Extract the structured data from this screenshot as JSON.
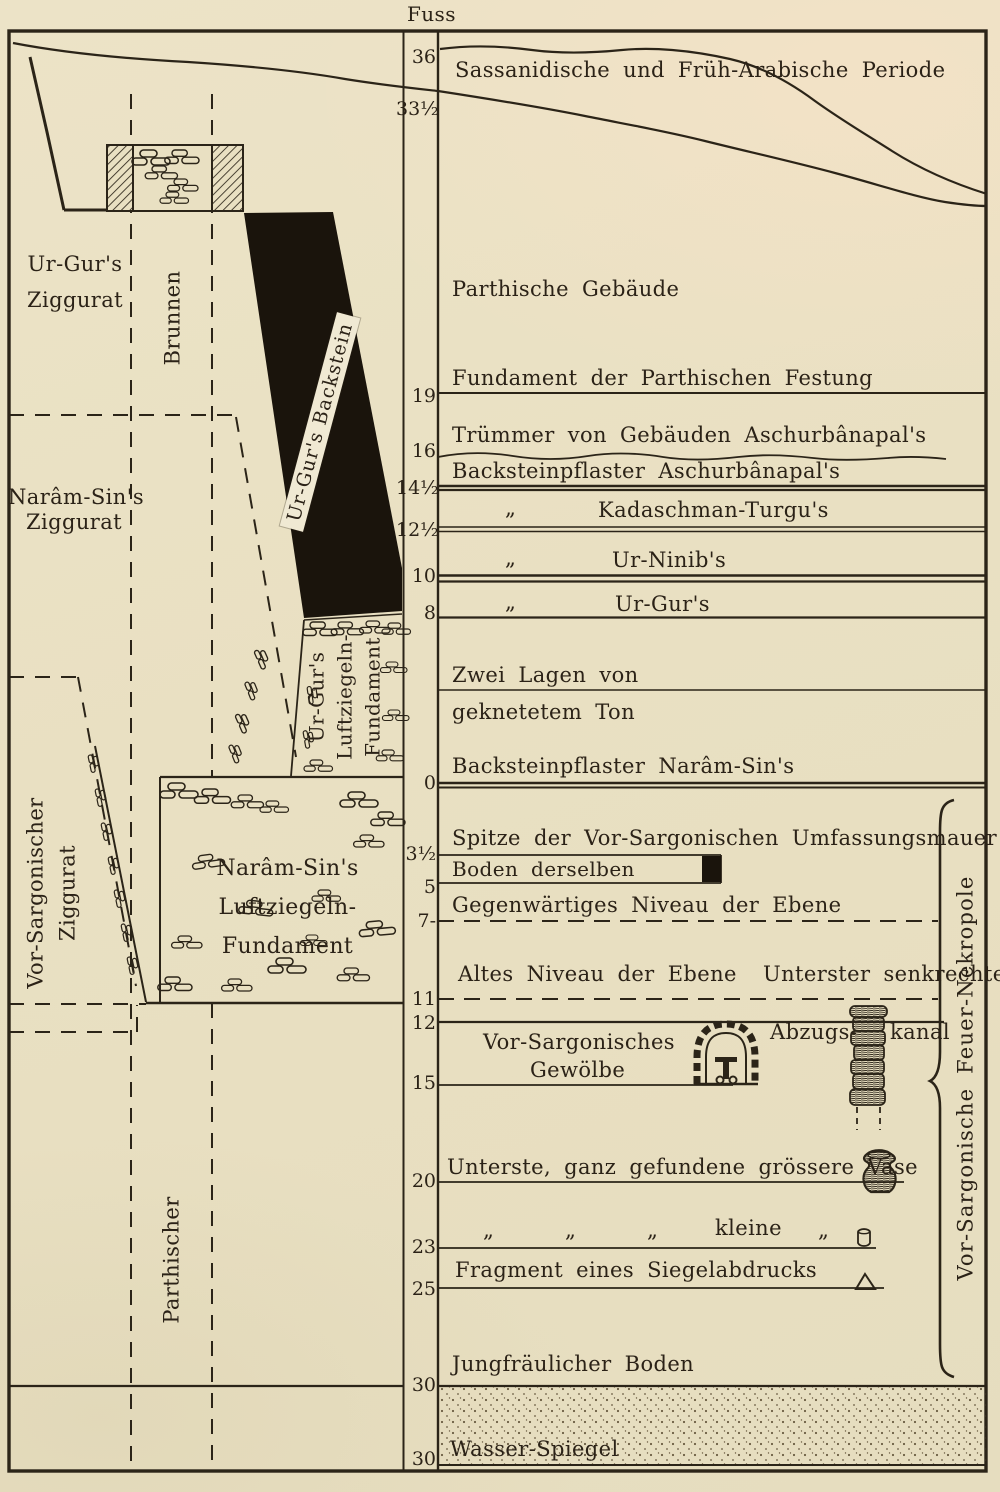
{
  "colors": {
    "paper": "#e9e0c2",
    "ink": "#2b2418"
  },
  "figure": {
    "unit_label": "Fuss",
    "scale_ticks": [
      "36",
      "33½",
      "19",
      "16",
      "14½",
      "12½",
      "10",
      "8",
      "0",
      "3½",
      "5",
      "7-",
      "11",
      "12",
      "15",
      "20",
      "23",
      "25",
      "30",
      "30"
    ],
    "left": {
      "ur_gur_ziggurat": [
        "Ur-Gur's",
        "Ziggurat"
      ],
      "brunnen": "Brunnen",
      "ur_gur_backstein": "Ur-Gur's Backstein",
      "naram_sin_ziggurat": [
        "Narâm-Sin's",
        "Ziggurat"
      ],
      "ur_gur_fundament": [
        "Ur-Gur's",
        "Luftziegeln-",
        "Fundament"
      ],
      "naram_sin_fundament": [
        "Narâm-Sin's",
        "Luftziegeln-",
        "Fundament"
      ],
      "vor_sargonischer_ziggurat": [
        "Vor-Sargonischer",
        "Ziggurat"
      ],
      "parthischer": "Parthischer"
    },
    "right": {
      "sassanidische_periode": "Sassanidische und Früh-Arabische Periode",
      "parthische_gebaeude": "Parthische Gebäude",
      "fundament_festung": "Fundament der Parthischen Festung",
      "truemmer": "Trümmer von Gebäuden Aschurbânapal's",
      "backstein_aschurbanapal": "Backsteinpflaster Aschurbânapal's",
      "ditto_mark": "„",
      "kadaschman_turgu": "Kadaschman-Turgu's",
      "ur_ninib": "Ur-Ninib's",
      "ur_gur": "Ur-Gur's",
      "zwei_lagen_von": "Zwei Lagen von",
      "geknetetem_ton": "geknetetem Ton",
      "backstein_naram_sin": "Backsteinpflaster Narâm-Sin's",
      "spitze_umfassungsmauer": "Spitze der Vor-Sargonischen Umfassungsmauer",
      "boden_derselben": "Boden derselben",
      "gegenwaertiges_niveau": "Gegenwärtiges Niveau der Ebene",
      "altes_niveau": "Altes Niveau der Ebene",
      "unterster_senkrechter": "Unterster senkrechter",
      "abzugs": "Abzugs-",
      "kanal": "kanal",
      "vor_sargonisches_gewoelbe": [
        "Vor-Sargonisches",
        "Gewölbe"
      ],
      "grosse_vase": "Unterste, ganz gefundene grössere Vase",
      "kleine": "kleine",
      "fragment_siegelabdruck": "Fragment eines Siegelabdrucks",
      "jungfraeulicher_boden": "Jungfräulicher Boden",
      "wasser_spiegel": "Wasser-Spiegel",
      "feuer_nekropole": "Vor-Sargonische Feuer-Nekropole"
    }
  }
}
